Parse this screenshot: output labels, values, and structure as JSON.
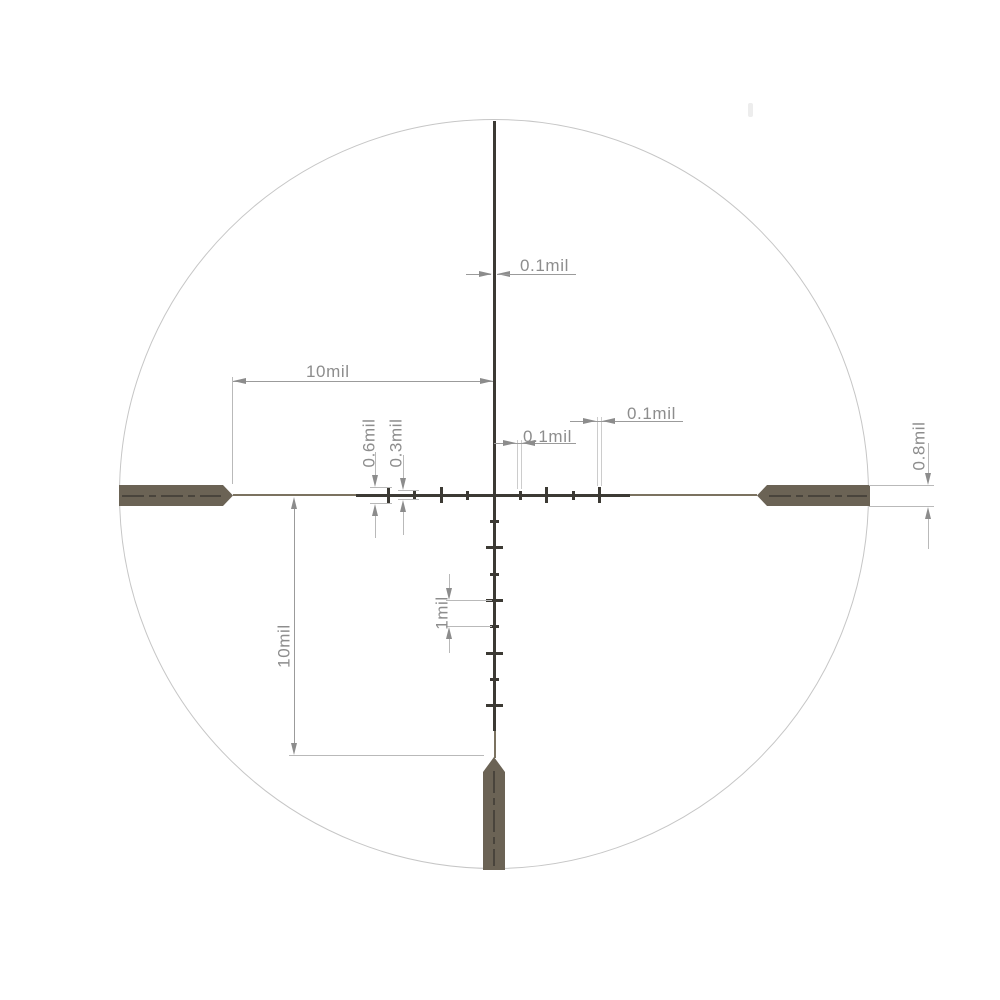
{
  "diagram": {
    "kind": "riflescope-reticle-subtension-drawing",
    "units": "mil",
    "labels": {
      "vline_width": "0.1mil",
      "inner_tick_width": "0.1mil",
      "outer_tick_width": "0.1mil",
      "long_tick_height": "0.6mil",
      "short_tick_height": "0.3mil",
      "post_thickness": "0.8mil",
      "tick_spacing": "1mil",
      "horizontal_span": "10mil",
      "vertical_span": "10mil"
    },
    "colors": {
      "reticle_dark": "#3c3a34",
      "reticle_thin_line": "#7b7260",
      "post_fill": "#6b6355",
      "post_centerline": "#49443c",
      "dimension_grey": "#8c8c8c",
      "extension_line": "#b9b9b9",
      "circle_stroke": "#c6c6c6",
      "background": "#ffffff"
    },
    "reticle": {
      "mil_px": 26.35,
      "center_x": 494,
      "center_y": 495,
      "circle_radius_px": 375,
      "horizontal_ticks": [
        {
          "mil": -4,
          "size": "long"
        },
        {
          "mil": -3,
          "size": "short"
        },
        {
          "mil": -2,
          "size": "long"
        },
        {
          "mil": -1,
          "size": "short"
        },
        {
          "mil": 1,
          "size": "short"
        },
        {
          "mil": 2,
          "size": "long"
        },
        {
          "mil": 3,
          "size": "short"
        },
        {
          "mil": 4,
          "size": "long"
        }
      ],
      "vertical_ticks": [
        {
          "mil": 1,
          "size": "short"
        },
        {
          "mil": 2,
          "size": "long"
        },
        {
          "mil": 3,
          "size": "short"
        },
        {
          "mil": 4,
          "size": "long"
        },
        {
          "mil": 5,
          "size": "short"
        },
        {
          "mil": 6,
          "size": "long"
        },
        {
          "mil": 7,
          "size": "short"
        },
        {
          "mil": 8,
          "size": "long"
        }
      ],
      "posts": [
        "left",
        "right",
        "bottom"
      ]
    }
  }
}
